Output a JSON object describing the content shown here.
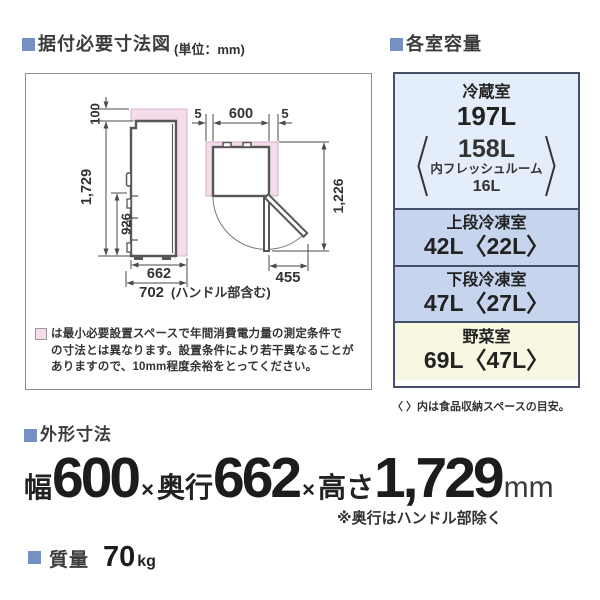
{
  "colors": {
    "bullet_blue": "#7590c2",
    "dimension_blue": "#2a6cb8",
    "clearance_pink": "#f4dcea",
    "table_border": "#46506a",
    "cell_fridge": "#e4eefa",
    "cell_freezer": "#c6d5ed",
    "cell_vegetable": "#f8f7e1"
  },
  "sections": {
    "installation": {
      "title": "据付必要寸法図",
      "unit": "(単位：mm)",
      "diagram": {
        "side": {
          "top_clearance": "100",
          "height": "1,729",
          "drawer_height": "926",
          "depth": "662",
          "depth_with_handle": "702",
          "handle_note": "(ハンドル部含む)"
        },
        "top": {
          "left_gap": "5",
          "width": "600",
          "right_gap": "5",
          "total_depth": "1,226",
          "door_open": "455"
        }
      },
      "note_lines": {
        "0": "は最小必要設置スペースで年間消費電力量の測定条件で",
        "1": "の寸法とは異なります。設置条件により若干異なることが",
        "2": "ありますので、10mm程度余裕をとってください。"
      }
    },
    "capacity": {
      "title": "各室容量",
      "rows": {
        "0": {
          "name": "冷蔵室",
          "value": "197L",
          "sub_value": "158L",
          "sub_label": "内フレッシュルーム",
          "sub_value2": "16L",
          "bracket_open": "〈",
          "bracket_close": "〉"
        },
        "1": {
          "name": "上段冷凍室",
          "value": "42L〈22L〉"
        },
        "2": {
          "name": "下段冷凍室",
          "value": "47L〈27L〉"
        },
        "3": {
          "name": "野菜室",
          "value": "69L〈47L〉"
        }
      },
      "footnote": "〈 〉内は食品収納スペースの目安。"
    },
    "external_dimensions": {
      "title": "外形寸法",
      "width_label": "幅",
      "width": "600",
      "x1": "×",
      "depth_label": "奥行",
      "depth": "662",
      "x2": "×",
      "height_label": "高さ",
      "height": "1,729",
      "unit": "mm",
      "note": "※奥行はハンドル部除く"
    },
    "mass": {
      "title": "質量",
      "value": "70",
      "unit": "kg"
    }
  }
}
